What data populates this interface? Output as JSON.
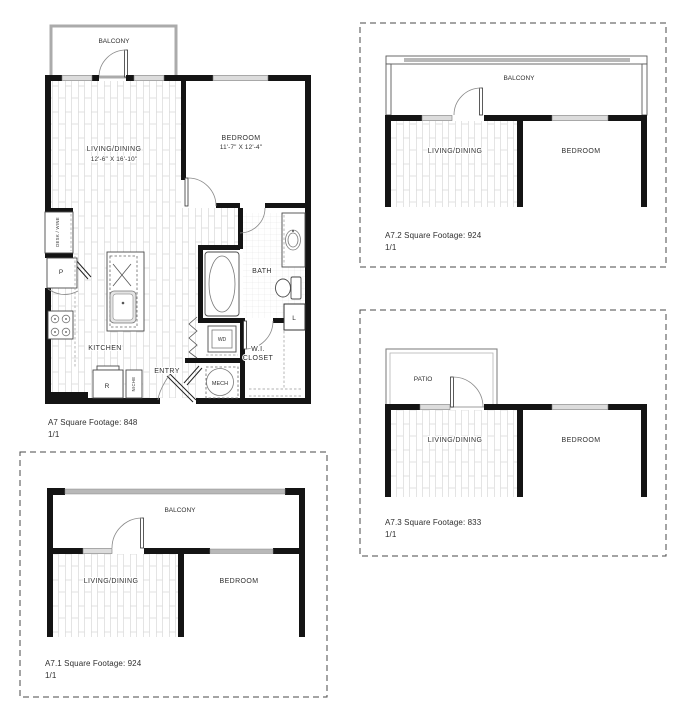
{
  "colors": {
    "wall": "#141414",
    "balcony_wall": "#ababab",
    "window_fill": "#dcdcdc",
    "rail": "#b8b8b8",
    "hatch": "#d9d9d9",
    "text": "#2f2f2f",
    "dashed_border": "#4a4a4a"
  },
  "plans": {
    "a7": {
      "caption": "A7 Square Footage: 848",
      "pages": "1/1",
      "labels": {
        "balcony": "BALCONY",
        "living": "LIVING/DINING",
        "living_dim": "12'-6\" X 16'-10\"",
        "bedroom": "BEDROOM",
        "bedroom_dim": "11'-7\" X 12'-4\"",
        "bath": "BATH",
        "kitchen": "KITCHEN",
        "entry": "ENTRY",
        "wi_line1": "W.I.",
        "wi_line2": "CLOSET",
        "mech": "MECH",
        "washer_dryer": "WD",
        "niche": "NICHE",
        "desk_wine": "DESK / WINE",
        "pantry": "P",
        "refrigerator": "R",
        "linen": "L"
      }
    },
    "a7_1": {
      "caption": "A7.1 Square Footage: 924",
      "pages": "1/1",
      "labels": {
        "balcony": "BALCONY",
        "living": "LIVING/DINING",
        "bedroom": "BEDROOM"
      }
    },
    "a7_2": {
      "caption": "A7.2 Square Footage: 924",
      "pages": "1/1",
      "labels": {
        "balcony": "BALCONY",
        "living": "LIVING/DINING",
        "bedroom": "BEDROOM"
      }
    },
    "a7_3": {
      "caption": "A7.3 Square Footage: 833",
      "pages": "1/1",
      "labels": {
        "patio": "PATIO",
        "living": "LIVING/DINING",
        "bedroom": "BEDROOM"
      }
    }
  }
}
